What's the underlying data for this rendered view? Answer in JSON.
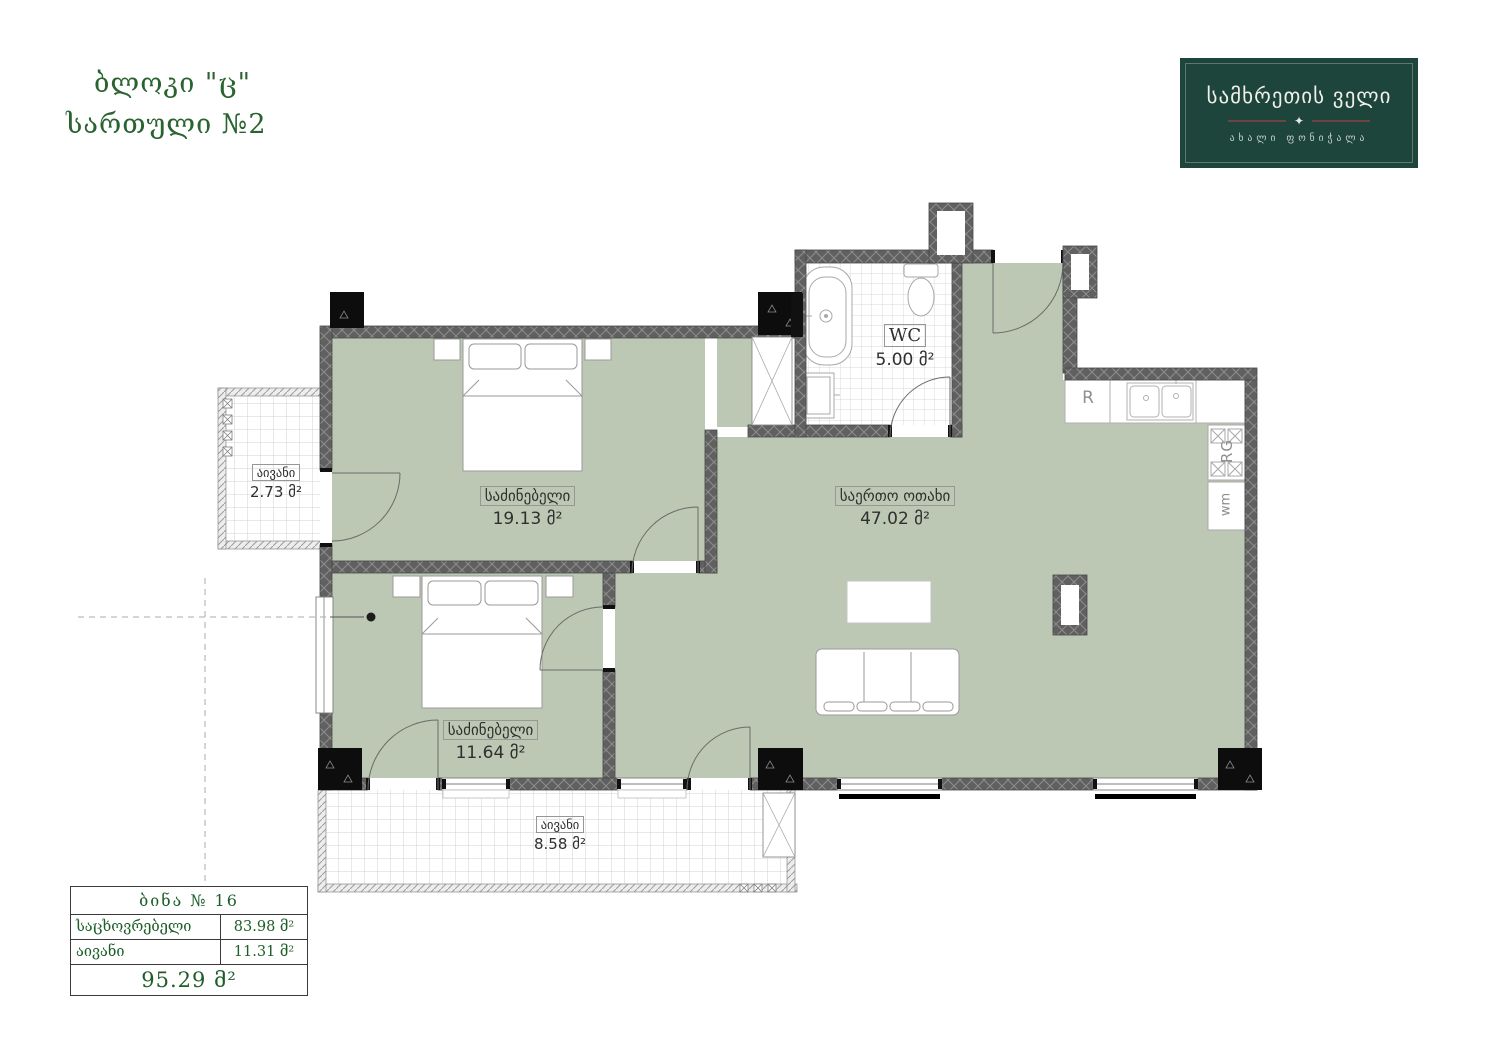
{
  "header": {
    "line1": "ბლოკი \"ც\"",
    "line2": "სართული №2"
  },
  "logo": {
    "title": "სამხრეთის ველი",
    "subtitle": "ახალი ფონიჭალა",
    "icon": "✦",
    "bg_color": "#1d453c"
  },
  "rooms": {
    "bedroom1": {
      "name": "საძინებელი",
      "area": "19.13 მ²"
    },
    "bedroom2": {
      "name": "საძინებელი",
      "area": "11.64 მ²"
    },
    "living": {
      "name": "საერთო ოთახი",
      "area": "47.02 მ²"
    },
    "wc": {
      "name": "WC",
      "area": "5.00 მ²"
    },
    "balcony_left": {
      "name": "აივანი",
      "area": "2.73 მ²"
    },
    "balcony_bottom": {
      "name": "აივანი",
      "area": "8.58 მ²"
    }
  },
  "appliances": {
    "fridge": "R",
    "range": "RG",
    "washer": "wm"
  },
  "table": {
    "title": "ბინა № 16",
    "rows": [
      {
        "label": "საცხოვრებელი",
        "value": "83.98 მ²"
      },
      {
        "label": "აივანი",
        "value": "11.31 მ²"
      }
    ],
    "total": "95.29 მ²"
  },
  "colors": {
    "accent_green": "#2a632f",
    "room_fill": "#bcc8b3",
    "wall_gray": "#606060",
    "logo_bg": "#1d453c"
  }
}
